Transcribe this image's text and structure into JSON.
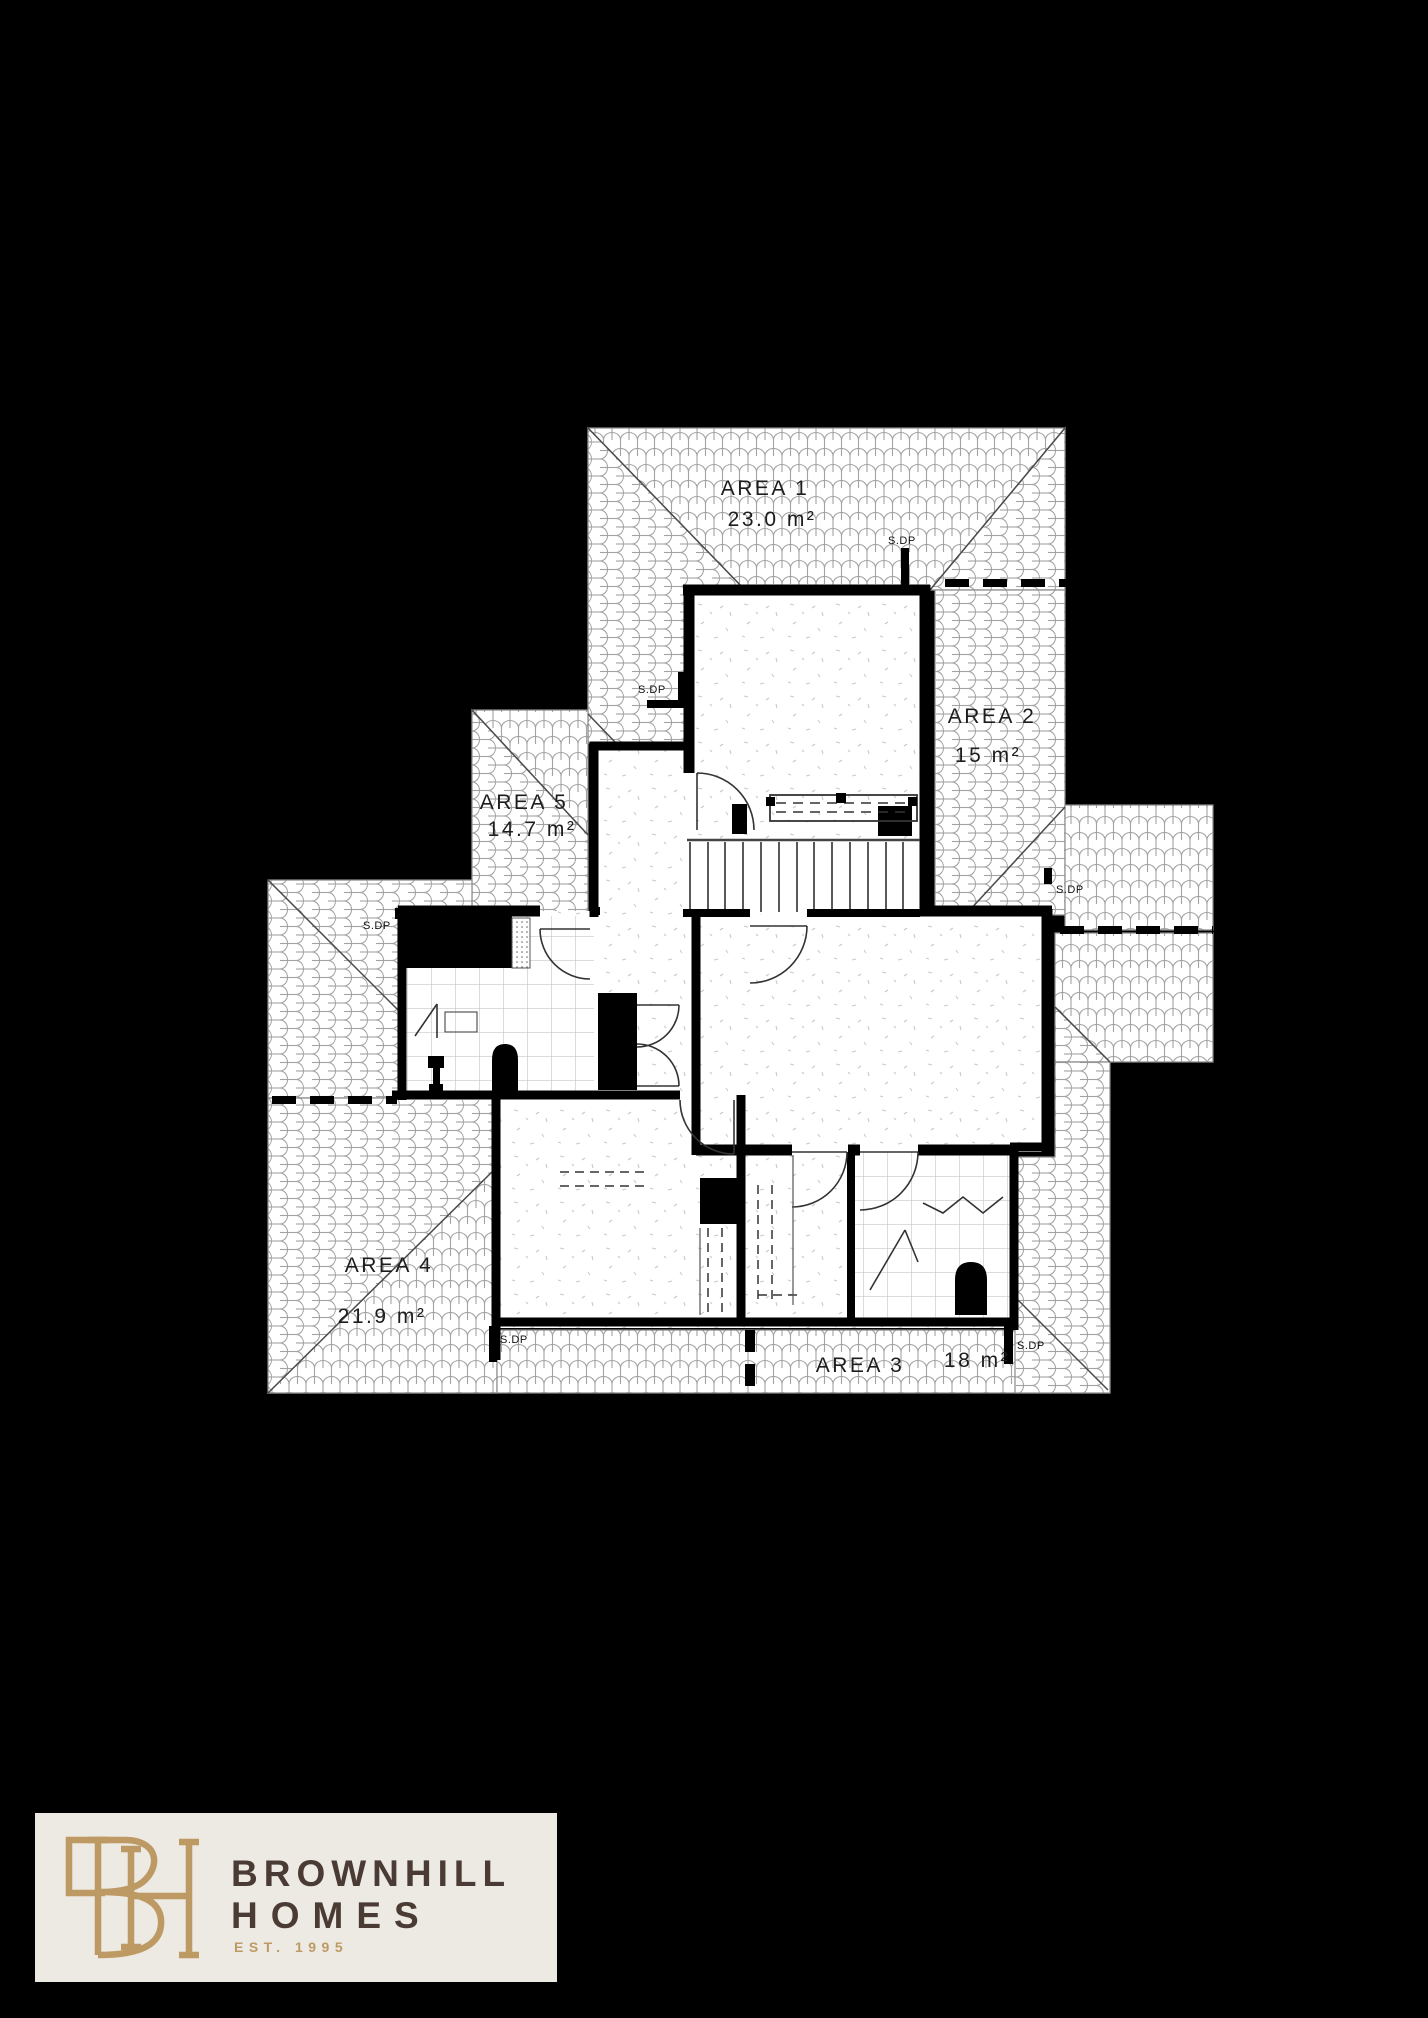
{
  "page": {
    "background": "#000000"
  },
  "plan": {
    "areas": [
      {
        "name": "AREA 1",
        "size": "23.0 m²"
      },
      {
        "name": "AREA 2",
        "size": "15 m²"
      },
      {
        "name": "AREA 3",
        "size": "18 m²"
      },
      {
        "name": "AREA 4",
        "size": "21.9 m²"
      },
      {
        "name": "AREA 5",
        "size": "14.7 m²"
      }
    ],
    "downpipes": [
      {
        "label": "S.DP"
      },
      {
        "label": "S.DP"
      },
      {
        "label": "S.DP"
      },
      {
        "label": "S.DP"
      },
      {
        "label": "S.DP"
      },
      {
        "label": "S.DP"
      }
    ]
  },
  "logo": {
    "monogram": "BH",
    "line1": "BROWNHILL",
    "line2": "HOMES",
    "tagline": "EST. 1995",
    "colors": {
      "gold": "#BD9A63",
      "brown": "#4A3B35",
      "panel": "#EDE9E3"
    }
  }
}
